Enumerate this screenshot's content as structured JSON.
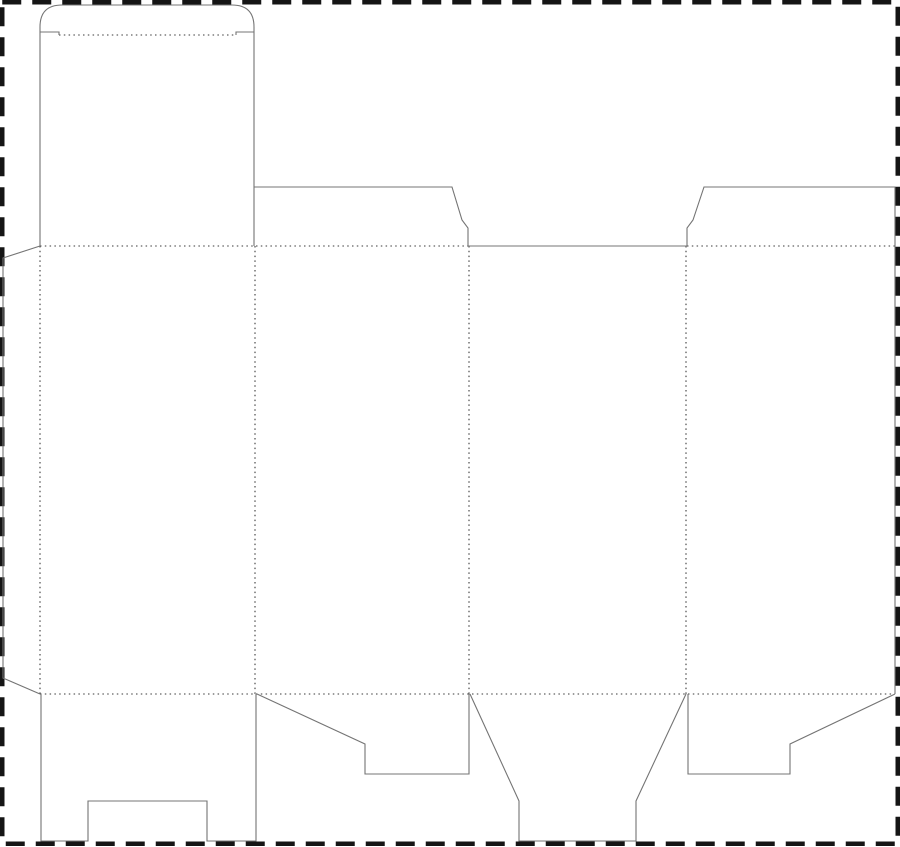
{
  "page": {
    "title": "carton-box-dieline-template",
    "background": "#ffffff"
  },
  "canvas": {
    "width": 900,
    "height": 847
  },
  "styles": {
    "cut_line": {
      "color": "#747474",
      "width": 1.1
    },
    "fold_line": {
      "color": "#3a3a3a",
      "width": 1.1,
      "dash": "1.5 3.3"
    },
    "sheet_border": {
      "color": "#151515",
      "width": 4.5,
      "dash": "19 11"
    }
  },
  "sheet_border": {
    "name": "sheet-cut-boundary",
    "x": 2.25,
    "y": 2.25,
    "width": 895.5,
    "height": 841.5
  },
  "dieline": {
    "cut_paths": [
      {
        "name": "tuck-lid-outline",
        "d": "M 40 246 L 40 27 Q 40 5 62 5 L 232 5 Q 254 5 254 27 L 254 246"
      },
      {
        "name": "tuck-slit-left",
        "d": "M 40 32 L 59 32 L 59 35"
      },
      {
        "name": "tuck-slit-right",
        "d": "M 254 32 L 236 32 L 236 35"
      },
      {
        "name": "dust-flap-top-left",
        "d": "M 254 187 L 452 187 L 462 220 L 468 228 L 468 246"
      },
      {
        "name": "top-edge-center-panel",
        "d": "M 468 246 L 687 246"
      },
      {
        "name": "dust-flap-top-right-and-side-edge",
        "d": "M 687 246 L 687 228 L 693 220 L 704 187 L 895 187 L 895 694"
      },
      {
        "name": "glue-flap-outline",
        "d": "M 40 246 L 3 258 L 3 678 L 40 694"
      },
      {
        "name": "bottom-flap-panel1-notched",
        "d": "M 41 694 L 41 841 L 88 841 L 88 801 L 207 801 L 207 841 L 256 841 L 256 694"
      },
      {
        "name": "bottom-flap-panel2-slant",
        "d": "M 257 694 L 365 744 L 365 774 L 469 774 L 469 694"
      },
      {
        "name": "bottom-flap-panel3-lock-tongue",
        "d": "M 470 694 L 519 801 L 519 841 L 636 841 L 636 801 L 686 694"
      },
      {
        "name": "bottom-flap-panel4-slant",
        "d": "M 688 694 L 688 774 L 790 774 L 790 744 L 895 694"
      }
    ],
    "fold_lines": [
      {
        "name": "tuck-flap-fold",
        "d": "M 59 35 L 236 35"
      },
      {
        "name": "top-fold-left-section",
        "d": "M 40 246 L 468 246"
      },
      {
        "name": "top-fold-right-section",
        "d": "M 687 246 L 895 246"
      },
      {
        "name": "bottom-fold",
        "d": "M 40 694 L 895 694"
      },
      {
        "name": "vertical-fold-glue-flap",
        "d": "M 40 246 L 40 694"
      },
      {
        "name": "vertical-fold-panel1-2",
        "d": "M 255 246 L 255 694"
      },
      {
        "name": "vertical-fold-panel2-3",
        "d": "M 469 246 L 469 694"
      },
      {
        "name": "vertical-fold-panel3-4",
        "d": "M 686 246 L 686 694"
      }
    ]
  }
}
